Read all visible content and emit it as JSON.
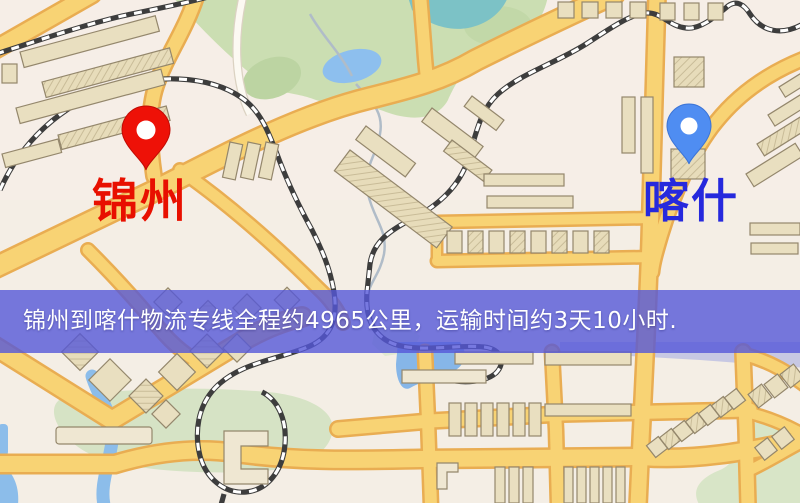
{
  "map": {
    "origin_marker": {
      "label": "锦州",
      "icon": "red-location-pin"
    },
    "destination_marker": {
      "label": "喀什",
      "icon": "blue-location-pin"
    },
    "banner": {
      "text": "锦州到喀什物流专线全程约4965公里，运输时间约3天10小时."
    },
    "route": {
      "distance_km": "4965",
      "duration": "3天10小时"
    }
  },
  "colors": {
    "banner_bg": "#5558d8",
    "banner_text": "#ffffff",
    "origin_pin": "#ee1107",
    "dest_pin": "#4f8df2",
    "origin_label": "#e81000",
    "dest_label": "#2629dd",
    "road_fill": "#f8d374",
    "road_casing": "#e9ad52",
    "park_green": "#cbdeb2",
    "water_blue": "#8dbfee",
    "building_fill": "#e9dfc0"
  }
}
